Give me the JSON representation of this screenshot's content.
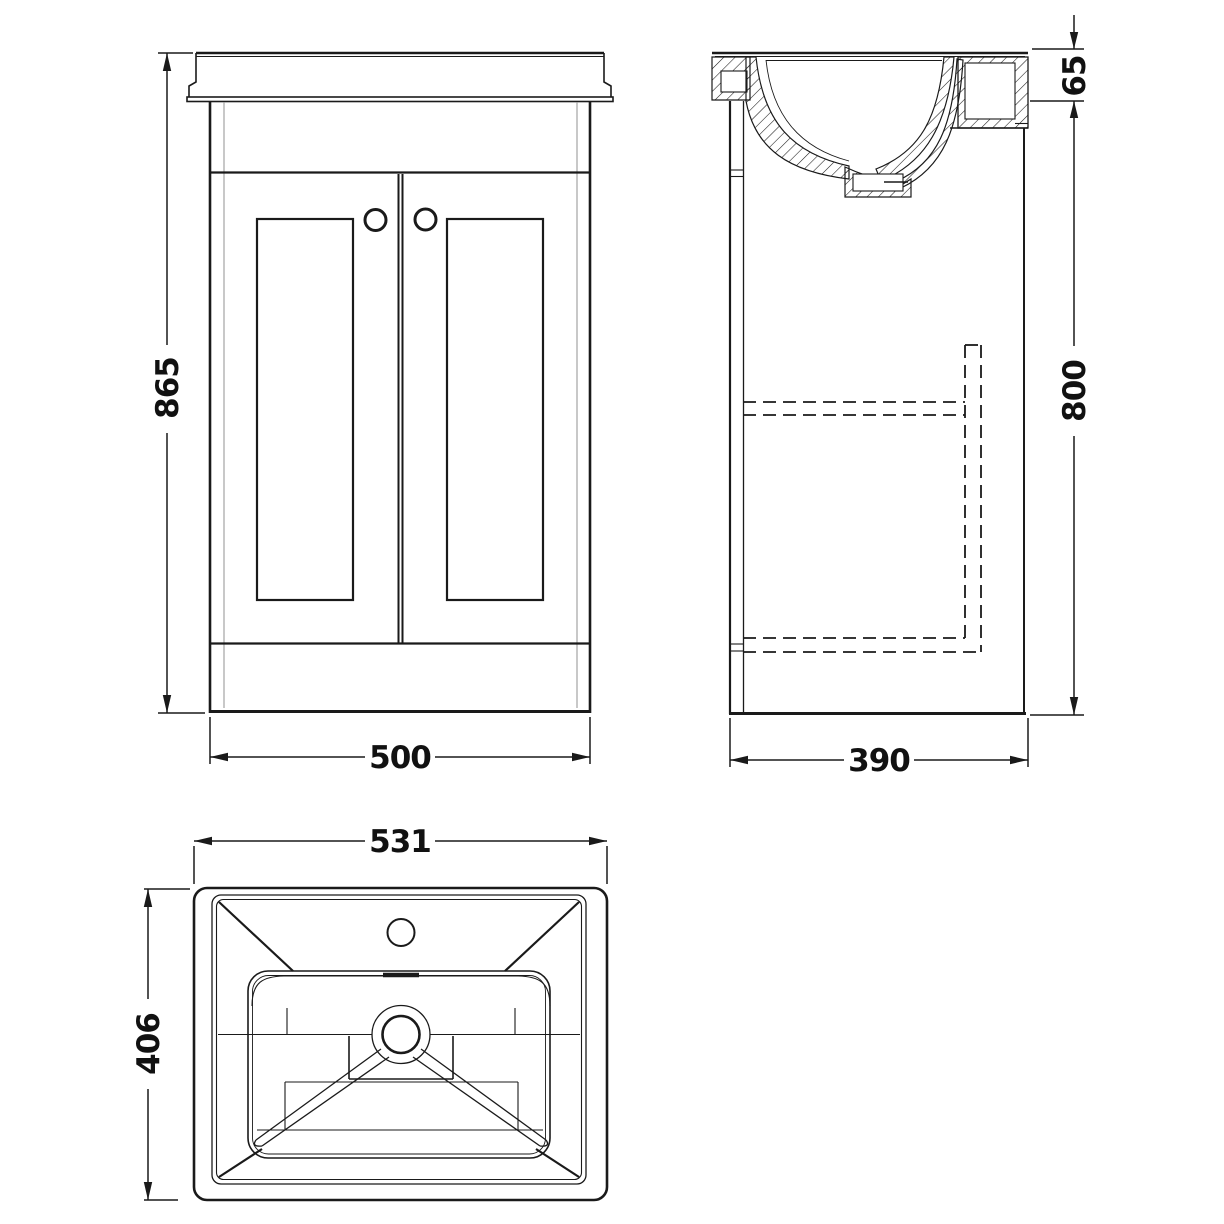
{
  "canvas": {
    "background": "#ffffff",
    "line_color": "#1a1a1a",
    "gray_line_color": "#9c9c9c"
  },
  "drawing": {
    "type": "technical-dimension-drawing",
    "subject": "vanity unit with inset basin, three orthographic views"
  },
  "views": {
    "front": {
      "name": "front-elevation",
      "height_mm": "865",
      "width_mm": "500"
    },
    "side": {
      "name": "side-section",
      "basin_rim_height_mm": "65",
      "cabinet_height_mm": "800",
      "depth_mm": "390"
    },
    "plan": {
      "name": "basin-plan",
      "basin_width_mm": "531",
      "basin_depth_mm": "406"
    }
  }
}
